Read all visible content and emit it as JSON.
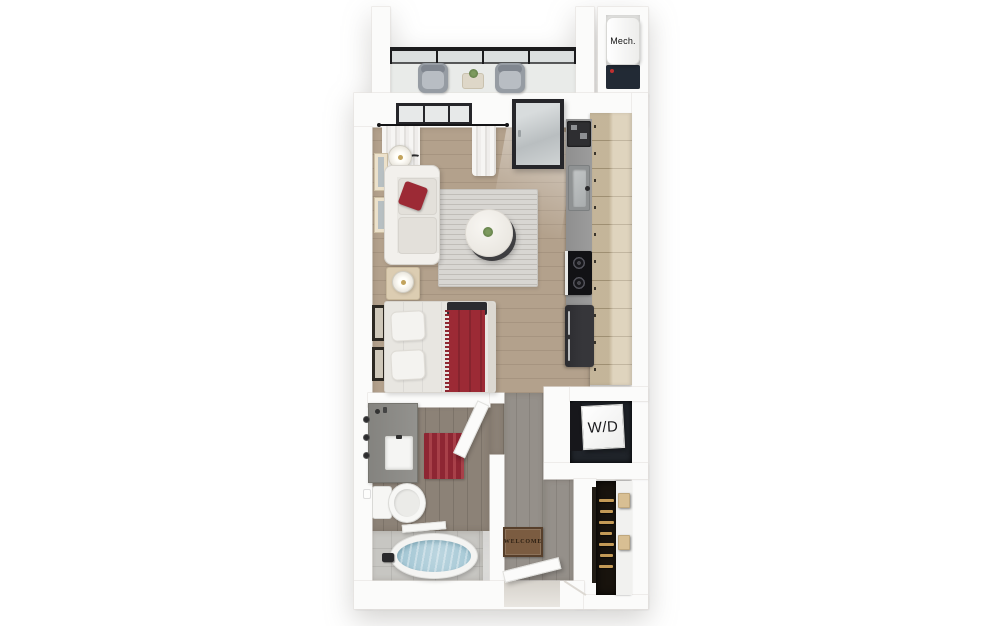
{
  "scene": {
    "type": "3d-studio-floorplan",
    "background": "#ffffff"
  },
  "labels": {
    "mech_room": "Mech.",
    "washer_dryer": "W/D",
    "welcome_mat": "WELCOME"
  },
  "colors": {
    "wall": "#fbfbfa",
    "wall-edge": "#e5e2de",
    "floor-wood": "#b3a18c",
    "floor-hall": "#95908a",
    "floor-bath": "#8c8277",
    "floor-tile": "#c7c6c2",
    "floor-balcony": "#e9ebe9",
    "cabinet": "#d3c3a5",
    "counter": "#9c9c9c",
    "appliance-dark": "#2e2e31",
    "fridge": "#36363a",
    "sofa": "#e9e7e2",
    "accent-red": "#9c2a35",
    "bed-dark": "#2c2c30",
    "rug": "#d8d6d2",
    "water": "#a7c9d6",
    "mat-brown": "#7b5c41",
    "mat-border": "#573f2b",
    "closet-dark": "#18130d",
    "hanger-gold": "#c49a56",
    "railing": "#1b1b1d",
    "frame-dark": "#26262a",
    "heater-base": "#222a35"
  }
}
